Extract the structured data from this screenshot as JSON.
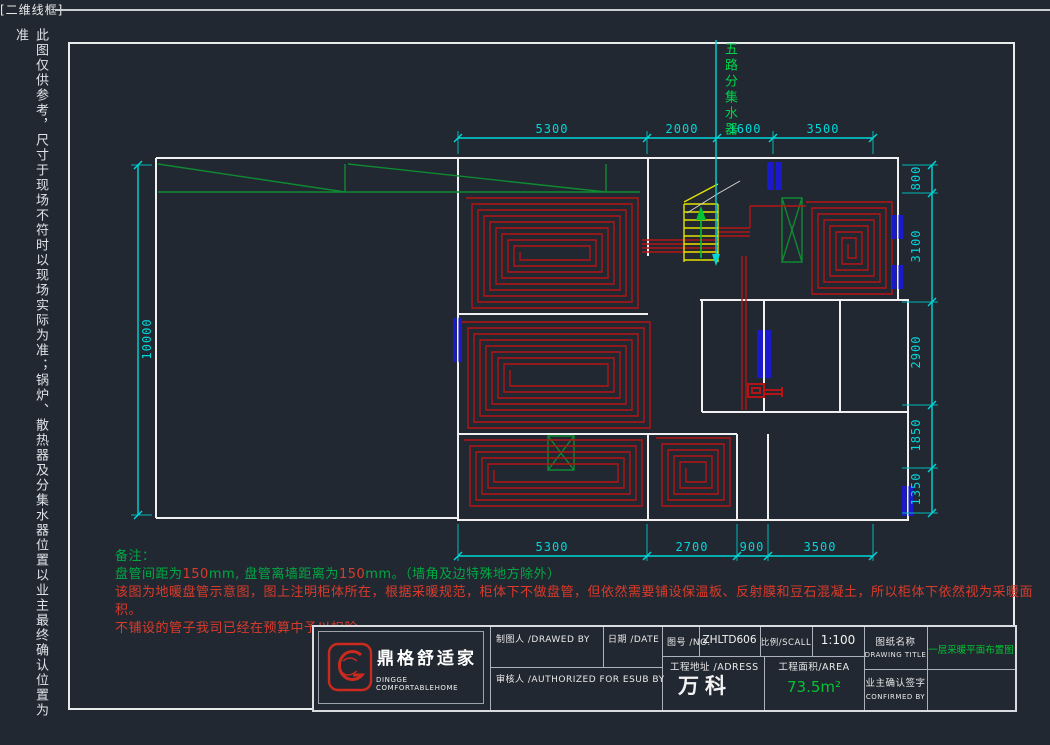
{
  "viewport_label": "[二维线框]",
  "side_note": "此图仅供参考，尺寸于现场不符时以现场实际为准；锅炉、散热器及分集水器位置以业主最终确认位置为准",
  "manifold_label": "五路分集水器",
  "dimensions": {
    "top": [
      "5300",
      "2000",
      "1600",
      "3500"
    ],
    "bottom": [
      "5300",
      "2700",
      "900",
      "3500"
    ],
    "right": [
      "800",
      "3100",
      "2900",
      "1850",
      "1350"
    ],
    "left": [
      "10000"
    ]
  },
  "notes": {
    "title": "备注：",
    "line1_segments": [
      {
        "text": "盘管间距为",
        "color": "green"
      },
      {
        "text": "150",
        "color": "red"
      },
      {
        "text": "mm, 盘管离墙距离为",
        "color": "green"
      },
      {
        "text": "150",
        "color": "red"
      },
      {
        "text": "mm。（墙角及边特殊地方除外）",
        "color": "green"
      }
    ],
    "line2": "该图为地暖盘管示意图，图上注明柜体所在，根据采暖规范，柜体下不做盘管，但依然需要铺设保温板、反射膜和豆石混凝土，所以柜体下依然视为采暖面积。",
    "line3": "不铺设的管子我司已经在预算中予以扣除。"
  },
  "title_block": {
    "logo_cn": "鼎格舒适家",
    "logo_en": "DINGGE COMFORTABLEHOME",
    "drawed_by_label": "制图人 /DRAWED BY",
    "date_label": "日期 /DATE",
    "authorized_label": "审核人 /AUTHORIZED FOR ESUB BY",
    "no_label": "图号 /NO.",
    "no_value": "ZHLTD606",
    "scale_label": "比例/SCALL",
    "scale_value": "1:100",
    "address_label": "工程地址 /ADRESS",
    "address_value": "万科",
    "area_label": "工程面积/AREA",
    "area_value": "73.5m²",
    "drawing_title_label_cn": "图纸名称",
    "drawing_title_label_en": "DRAWING TITLE",
    "drawing_title_value": "一层采暖平面布置图",
    "confirm_label_cn": "业主确认签字",
    "confirm_label_en": "CONFIRMED BY"
  },
  "colors": {
    "background": "#222831",
    "dimension_cyan": "#00d7d7",
    "pipe_red": "#b41414",
    "wall_white": "#f0f0f0",
    "window_blue": "#1a1acc",
    "hatch_green": "#0e8a32",
    "text_green": "#00c432",
    "note_red": "#d93b2b",
    "stair_yellow": "#e2e200"
  }
}
